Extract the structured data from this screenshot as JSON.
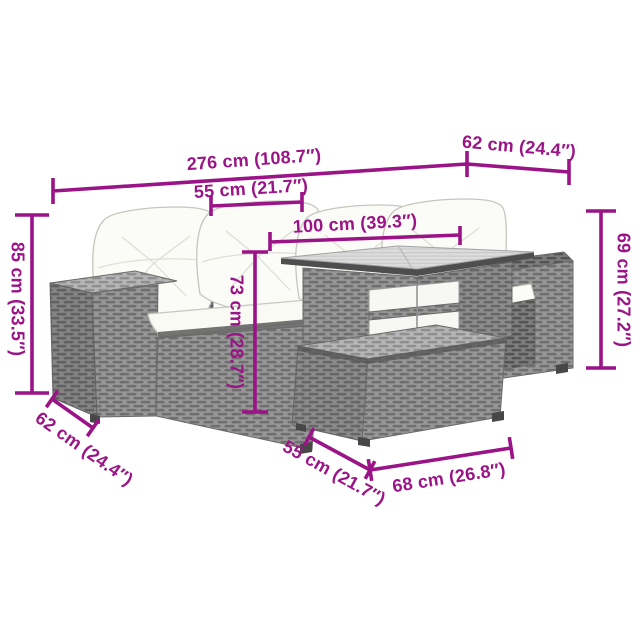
{
  "figure": {
    "kind": "furniture-dimension-diagram",
    "pieces": [
      "left-armrest-module",
      "two-seat-sofa",
      "back-cushions",
      "seat-cushions",
      "glass-top-table",
      "ottoman",
      "right-armrest-module"
    ]
  },
  "colors": {
    "accent": "#9B1487",
    "rattan": "#979797",
    "rattan_dark": "#7D7D7D",
    "rattan_light": "#B6B6B6",
    "cushion": "#FBFBF7",
    "glass": "#DCDCDC",
    "background": "#FFFFFF"
  },
  "dims": {
    "total_width": "276 cm (108.7″)",
    "top_depth": "62 cm (24.4″)",
    "seat_width": "55 cm (21.7″)",
    "table_width": "100 cm (39.3″)",
    "sofa_height": "85 cm (33.5″)",
    "table_height": "73 cm (28.7″)",
    "side_height": "69 cm (27.2″)",
    "sofa_depth": "62 cm (24.4″)",
    "ottoman_depth": "55 cm (21.7″)",
    "ottoman_width": "68 cm (26.8″)"
  }
}
